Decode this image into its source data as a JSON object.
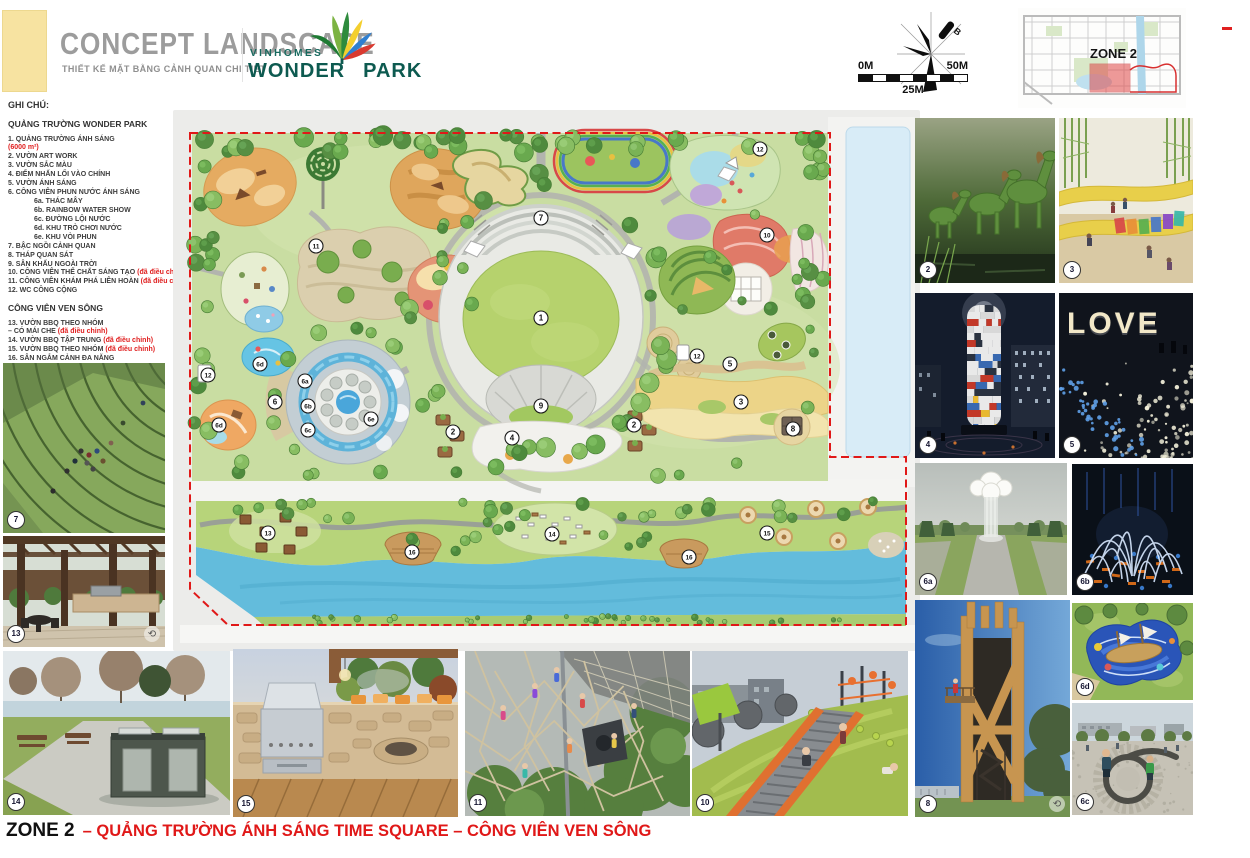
{
  "header": {
    "title": "CONCEPT LANDSCAPE",
    "subtitle": "THIẾT KẾ MẶT BẰNG CẢNH QUAN CHI TIẾT",
    "brand_top": "VINHOMES",
    "brand_word1": "WONDER",
    "brand_word2": "PARK"
  },
  "north": {
    "label": "B"
  },
  "scalebar": {
    "left": "0M",
    "right": "50M",
    "mid": "25M"
  },
  "keymap": {
    "zone_label": "ZONE 2"
  },
  "legend": {
    "heading": "GHI CHÚ:",
    "sections": [
      {
        "title": "QUẢNG TRƯỜNG WONDER PARK",
        "items": [
          {
            "text": "1.  QUẢNG TRƯỜNG ÁNH SÁNG",
            "note2": "(6000 m²)"
          },
          {
            "text": "2. VƯỜN ART WORK"
          },
          {
            "text": "3. VƯỜN SẮC MÀU"
          },
          {
            "text": "4. ĐIỂM NHẤN LỐI VÀO CHÍNH"
          },
          {
            "text": "5. VƯỜN ÁNH SÁNG"
          },
          {
            "text": "6. CÔNG VIÊN PHUN NƯỚC ÁNH SÁNG"
          },
          {
            "text": "6a. THÁC MÂY",
            "sub": true
          },
          {
            "text": "6b. RAINBOW WATER SHOW",
            "sub": true
          },
          {
            "text": "6c. ĐƯỜNG LỘI NƯỚC",
            "sub": true
          },
          {
            "text": "6d. KHU TRÒ CHƠI NƯỚC",
            "sub": true
          },
          {
            "text": "6e. KHU VÒI PHUN",
            "sub": true
          },
          {
            "text": "7. BẬC NGỒI CẢNH QUAN"
          },
          {
            "text": "8. THÁP QUAN SÁT"
          },
          {
            "text": "9. SÂN KHẤU NGOÀI TRỜI"
          },
          {
            "text": "10. CÔNG VIÊN THỂ CHẤT SÁNG TẠO  ",
            "note": "(đã điều chỉnh)"
          },
          {
            "text": "11. CÔNG VIÊN KHÁM PHÁ LIÊN HOÀN ",
            "note": "(đã điều chỉnh)"
          },
          {
            "text": "12. WC CÔNG CỘNG"
          }
        ]
      },
      {
        "title": "CÔNG VIÊN VEN SÔNG",
        "items": [
          {
            "text": "13. VƯỜN BBQ THEO NHÓM",
            "text2": "– CÓ MÁI CHE ",
            "note": "(đã điều chỉnh)"
          },
          {
            "text": "14. VƯỜN BBQ TẬP TRUNG ",
            "note": "(đã điều chỉnh)"
          },
          {
            "text": "15. VƯỜN BBQ THEO NHÓM ",
            "note": "(đã điều chỉnh)"
          },
          {
            "text": "16. SÂN NGẮM CẢNH ĐA NĂNG"
          }
        ]
      }
    ]
  },
  "plan": {
    "markers": [
      {
        "label": "1",
        "x": 361,
        "y": 201
      },
      {
        "label": "7",
        "x": 361,
        "y": 101
      },
      {
        "label": "9",
        "x": 361,
        "y": 289
      },
      {
        "label": "4",
        "x": 332,
        "y": 321
      },
      {
        "label": "2",
        "x": 273,
        "y": 315
      },
      {
        "label": "2",
        "x": 454,
        "y": 308
      },
      {
        "label": "11",
        "x": 136,
        "y": 129
      },
      {
        "label": "10",
        "x": 587,
        "y": 118
      },
      {
        "label": "12",
        "x": 580,
        "y": 32
      },
      {
        "label": "12",
        "x": 517,
        "y": 239
      },
      {
        "label": "12",
        "x": 28,
        "y": 258
      },
      {
        "label": "5",
        "x": 550,
        "y": 247
      },
      {
        "label": "3",
        "x": 561,
        "y": 285
      },
      {
        "label": "8",
        "x": 613,
        "y": 312
      },
      {
        "label": "6",
        "x": 95,
        "y": 285
      },
      {
        "label": "6a",
        "x": 125,
        "y": 264
      },
      {
        "label": "6b",
        "x": 128,
        "y": 289
      },
      {
        "label": "6c",
        "x": 128,
        "y": 313
      },
      {
        "label": "6d",
        "x": 80,
        "y": 247
      },
      {
        "label": "6d",
        "x": 39,
        "y": 308
      },
      {
        "label": "6e",
        "x": 191,
        "y": 302
      },
      {
        "label": "13",
        "x": 88,
        "y": 416
      },
      {
        "label": "16",
        "x": 232,
        "y": 435
      },
      {
        "label": "14",
        "x": 372,
        "y": 417
      },
      {
        "label": "16",
        "x": 509,
        "y": 440
      },
      {
        "label": "15",
        "x": 587,
        "y": 416
      }
    ]
  },
  "photos": [
    {
      "badge": "7",
      "kind": "grass-amphitheater"
    },
    {
      "badge": "13",
      "kind": "pergola-bbq"
    },
    {
      "badge": "14",
      "kind": "park-bbq-station"
    },
    {
      "badge": "15",
      "kind": "stone-bbq-kitchen"
    },
    {
      "badge": "11",
      "kind": "climbing-nets"
    },
    {
      "badge": "10",
      "kind": "hill-roller-slide"
    },
    {
      "badge": "2",
      "kind": "topiary-horses"
    },
    {
      "badge": "3",
      "kind": "rainbow-ribbon-playground"
    },
    {
      "badge": "4",
      "kind": "light-tower-night"
    },
    {
      "badge": "5",
      "kind": "led-rose-field",
      "sign": "LOVE"
    },
    {
      "badge": "6a",
      "kind": "cloud-waterfall"
    },
    {
      "badge": "6b",
      "kind": "illuminated-fountain"
    },
    {
      "badge": "8",
      "kind": "wooden-observation-tower"
    },
    {
      "badge": "6d",
      "kind": "aerial-water-playground"
    },
    {
      "badge": "6c",
      "kind": "stone-spiral-water-channel"
    }
  ],
  "caption": {
    "zone": "ZONE 2",
    "rest": "– QUẢNG TRƯỜNG ÁNH SÁNG TIME SQUARE – CÔNG VIÊN VEN SÔNG"
  }
}
